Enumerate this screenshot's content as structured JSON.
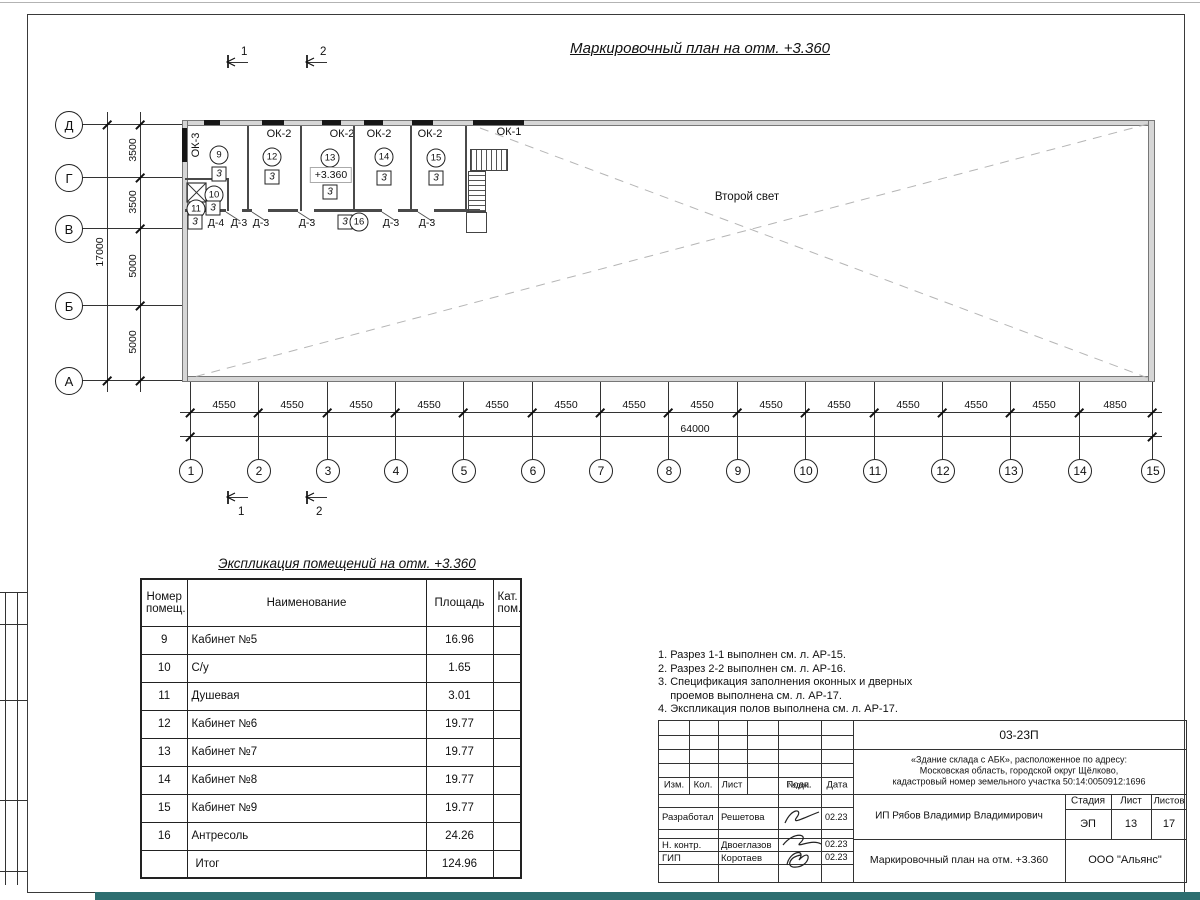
{
  "plan": {
    "title": "Маркировочный план на отм. +3.360",
    "second_light": "Второй свет",
    "rows": [
      "Д",
      "Г",
      "В",
      "Б",
      "А"
    ],
    "row_dims": [
      "3500",
      "3500",
      "5000",
      "5000"
    ],
    "cols": [
      "1",
      "2",
      "3",
      "4",
      "5",
      "6",
      "7",
      "8",
      "9",
      "10",
      "11",
      "12",
      "13",
      "14",
      "15"
    ],
    "col_dims": [
      "4550",
      "4550",
      "4550",
      "4550",
      "4550",
      "4550",
      "4550",
      "4550",
      "4550",
      "4550",
      "4550",
      "4550",
      "4550",
      "4850"
    ],
    "totals": {
      "width": "64000",
      "height": "17000"
    },
    "windows": {
      "ok1": "ОК-1",
      "ok2": "ОК-2",
      "ok3": "ОК-3"
    },
    "markers": {
      "m9": "9",
      "m10": "10",
      "m11": "11",
      "m12": "12",
      "m13": "13",
      "m14": "14",
      "m15": "15",
      "m16": "16",
      "box": "3",
      "elevation": "+3.360"
    },
    "doors": {
      "d4": "Д-4",
      "d3": "Д-3"
    },
    "sections": {
      "s1": "1",
      "s2": "2"
    }
  },
  "table": {
    "title": "Экспликация помещений на отм. +3.360",
    "headers": {
      "num": "Номер помещ.",
      "name": "Наименование",
      "area": "Площадь",
      "cat": "Кат. пом."
    },
    "rows": [
      {
        "num": "9",
        "name": "Кабинет №5",
        "area": "16.96"
      },
      {
        "num": "10",
        "name": "С/у",
        "area": "1.65"
      },
      {
        "num": "11",
        "name": "Душевая",
        "area": "3.01"
      },
      {
        "num": "12",
        "name": "Кабинет №6",
        "area": "19.77"
      },
      {
        "num": "13",
        "name": "Кабинет №7",
        "area": "19.77"
      },
      {
        "num": "14",
        "name": "Кабинет №8",
        "area": "19.77"
      },
      {
        "num": "15",
        "name": "Кабинет №9",
        "area": "19.77"
      },
      {
        "num": "16",
        "name": "Антресоль",
        "area": "24.26"
      },
      {
        "num": "",
        "name": "Итог",
        "area": "124.96"
      }
    ]
  },
  "notes": {
    "text": "1. Разрез 1-1 выполнен см. л. АР-15.\n2. Разрез 2-2 выполнен см. л. АР-16.\n3. Спецификация заполнения оконных и дверных\n    проемов выполнена см. л. АР-17.\n4. Экспликация полов выполнена см. л. АР-17."
  },
  "stamp": {
    "code": "03-23П",
    "object": "«Здание склада с АБК», расположенное по адресу:\nМосковская область, городской округ Щёлково,\nкадастровый номер земельного участка 50:14:0050912:1696",
    "header_cols": [
      "Изм.",
      "Кол.",
      "Лист",
      "№док.",
      "Подп.",
      "Дата"
    ],
    "roles": [
      {
        "role": "Разработал",
        "name": "Решетова",
        "date": "02.23"
      },
      {
        "role": "Н. контр.",
        "name": "Двоеглазов",
        "date": "02.23"
      },
      {
        "role": "ГИП",
        "name": "Коротаев",
        "date": "02.23"
      }
    ],
    "client": "ИП Рябов Владимир Владимирович",
    "stage_label": "Стадия",
    "sheet_label": "Лист",
    "sheets_label": "Листов",
    "stage": "ЭП",
    "sheet": "13",
    "sheets": "17",
    "drawing_title": "Маркировочный план на отм. +3.360",
    "company": "ООО \"Альянс\"",
    "colors": {
      "accent_bar": "#2d6e70",
      "line": "#333333",
      "wall_fill": "#d6d6d6"
    }
  }
}
